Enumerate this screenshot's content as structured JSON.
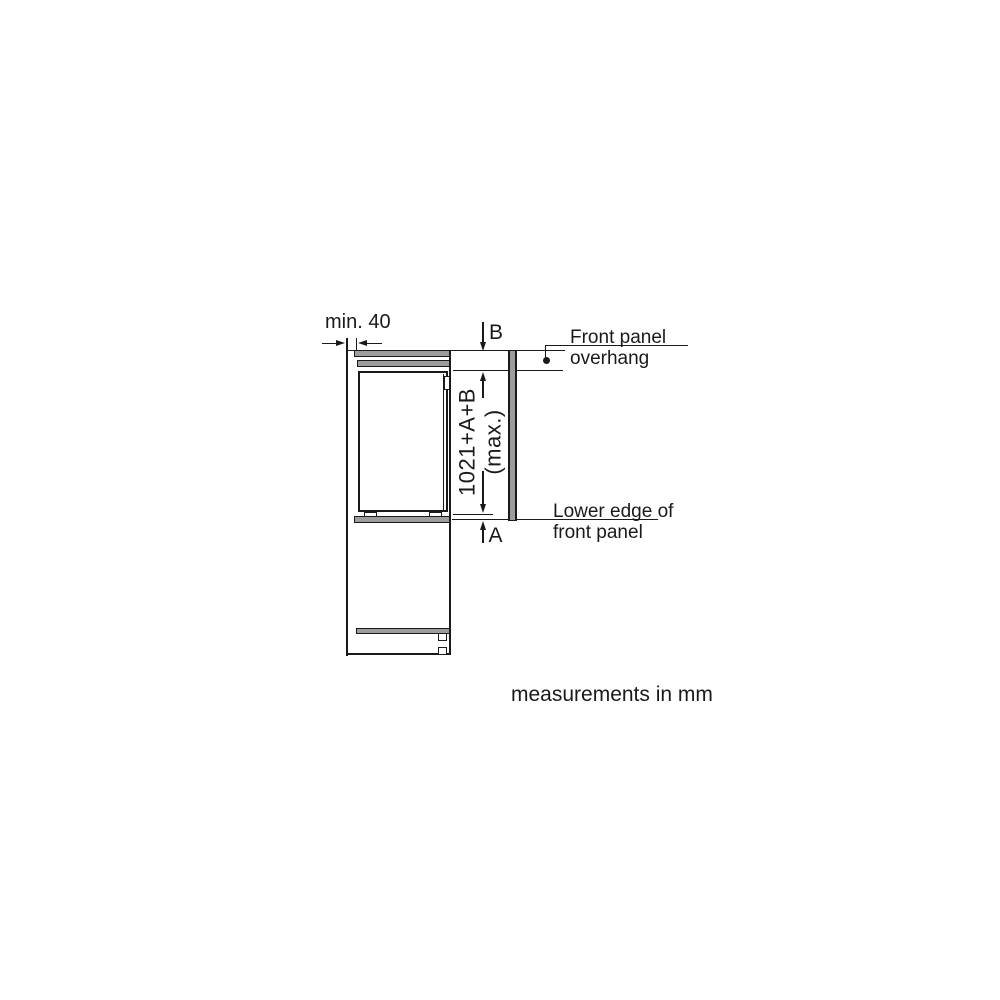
{
  "diagram": {
    "labels": {
      "min_clearance": "min. 40",
      "dim_b": "B",
      "dim_a": "A",
      "panel_height_line1": "1021+A+B",
      "panel_height_line2": "(max.)",
      "front_panel_overhang_line1": "Front panel",
      "front_panel_overhang_line2": "overhang",
      "lower_edge_line1": "Lower edge of",
      "lower_edge_line2": "front panel",
      "units_note": "measurements in mm"
    },
    "colors": {
      "line": "#1a1a1a",
      "panel_fill": "#9d9d9d",
      "background": "#ffffff"
    }
  }
}
